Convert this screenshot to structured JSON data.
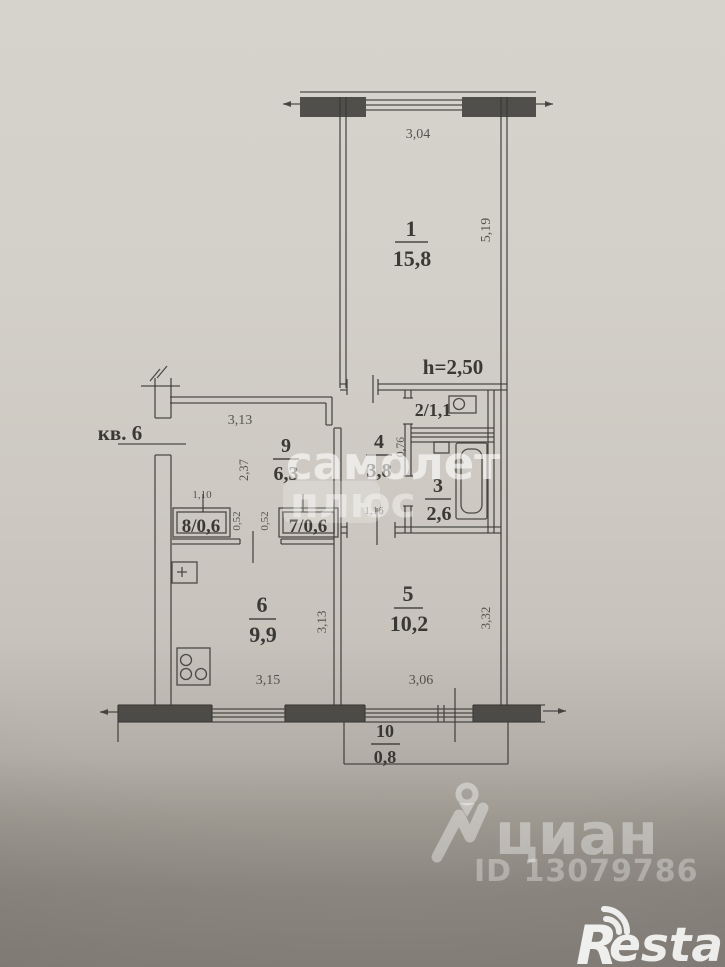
{
  "plan": {
    "apartment": "кв. 6",
    "ceiling": "h=2,50",
    "rooms": {
      "r1": {
        "num": "1",
        "area": "15,8"
      },
      "r2": {
        "label": "2/1,1"
      },
      "r3": {
        "num": "3",
        "area": "2,6"
      },
      "r4": {
        "num": "4",
        "area": "3,8"
      },
      "r5": {
        "num": "5",
        "area": "10,2"
      },
      "r6": {
        "num": "6",
        "area": "9,9"
      },
      "r7": {
        "label": "7/0,6"
      },
      "r8": {
        "label": "8/0,6"
      },
      "r9": {
        "num": "9",
        "area": "6,3"
      },
      "r10": {
        "num": "10",
        "area": "0,8"
      }
    },
    "dims": {
      "top_width": "3,04",
      "right_height": "5,19",
      "corridor_width": "3,13",
      "corridor_depth": "2,37",
      "closet8_width": "1,10",
      "gap_left": "0,52",
      "gap_right": "0,52",
      "toilet_wall": "0,76",
      "hall_width": "1,16",
      "kitchen_width": "3,15",
      "kitchen_depth": "3,13",
      "room5_width": "3,06",
      "room5_depth": "3,32"
    }
  },
  "watermarks": {
    "agency_line1": "самолет",
    "agency_line2": "плюс",
    "portal_name": "циан",
    "listing_id": "ID 13079786",
    "brand_r": "R",
    "brand_rest": "estate"
  },
  "colors": {
    "ink": "#3b3935",
    "paper_top": "#d6d3cc",
    "background_bottom": "#86817a",
    "watermark": "#ffffff"
  }
}
